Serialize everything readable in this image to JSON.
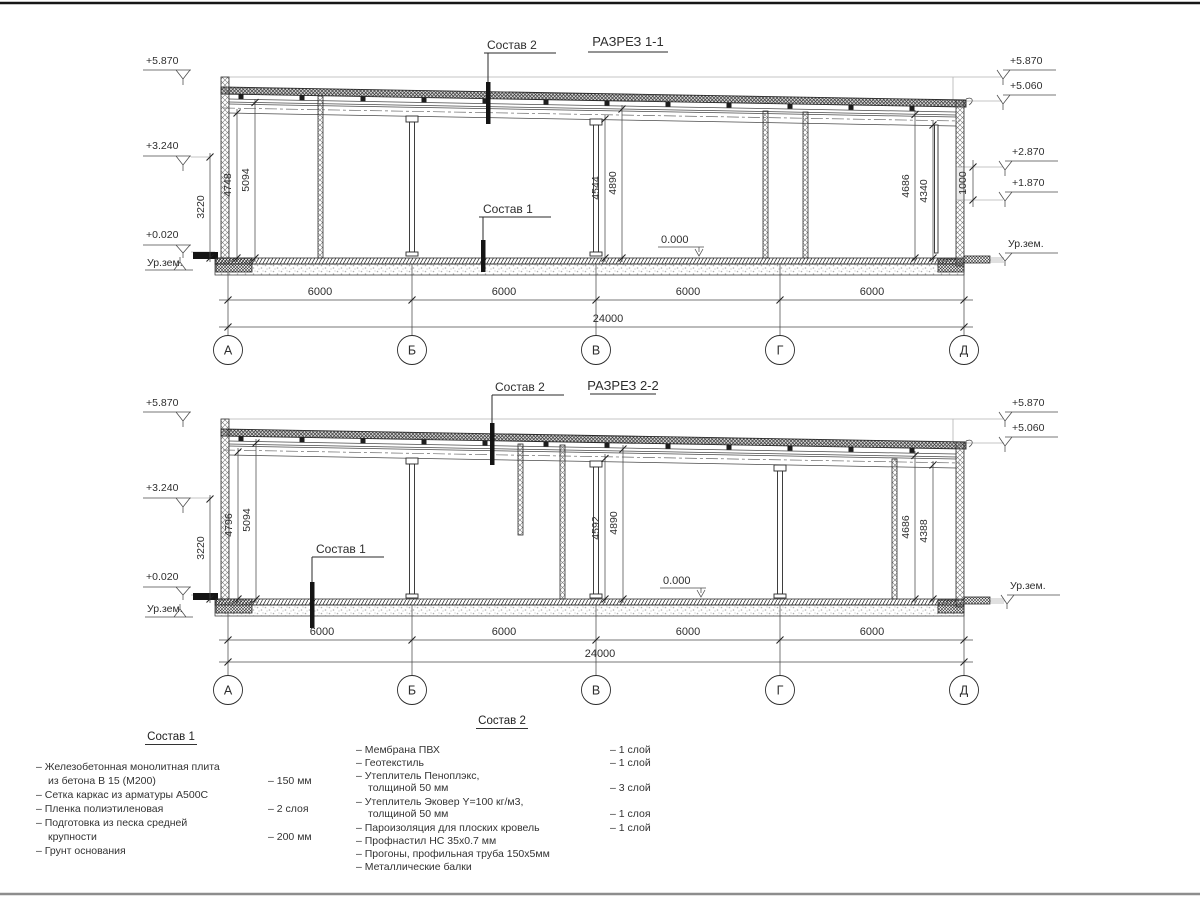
{
  "colors": {
    "line": "#2a2a2a",
    "gray": "#b3b3b3",
    "background": "#ffffff"
  },
  "s1": {
    "title": "РАЗРЕЗ 1-1",
    "sostav2": "Состав 2",
    "sostav1": "Состав 1",
    "zero": "0.000",
    "el_l1": "+5.870",
    "el_l2": "+3.240",
    "el_l3": "+0.020",
    "el_lg": "Ур.зем.",
    "el_r1": "+5.870",
    "el_r2": "+5.060",
    "el_r3": "+2.870",
    "el_r4": "+1.870",
    "el_rg": "Ур.зем.",
    "vd1": "3220",
    "vd2": "4748",
    "vd3": "5094",
    "vd4": "4544",
    "vd5": "4890",
    "vd6": "4686",
    "vd7": "4340",
    "vd8": "1000",
    "hd1": "6000",
    "hd2": "6000",
    "hd3": "6000",
    "hd4": "6000",
    "total": "24000",
    "ax1": "А",
    "ax2": "Б",
    "ax3": "В",
    "ax4": "Г",
    "ax5": "Д"
  },
  "s2": {
    "title": "РАЗРЕЗ 2-2",
    "sostav2": "Состав 2",
    "sostav1": "Состав 1",
    "zero": "0.000",
    "el_l1": "+5.870",
    "el_l2": "+3.240",
    "el_l3": "+0.020",
    "el_lg": "Ур.зем.",
    "el_r1": "+5.870",
    "el_r2": "+5.060",
    "el_rg": "Ур.зем.",
    "vd1": "3220",
    "vd2": "4796",
    "vd3": "5094",
    "vd4": "4592",
    "vd5": "4890",
    "vd6": "4686",
    "vd7": "4388",
    "hd1": "6000",
    "hd2": "6000",
    "hd3": "6000",
    "hd4": "6000",
    "total": "24000",
    "ax1": "А",
    "ax2": "Б",
    "ax3": "В",
    "ax4": "Г",
    "ax5": "Д"
  },
  "c1": {
    "title": "Состав 1",
    "rows": [
      {
        "t": "– Железобетонная  монолитная плита",
        "q": ""
      },
      {
        "t": "из бетона В 15 (М200)",
        "q": "– 150 мм"
      },
      {
        "t": "– Сетка каркас из арматуры А500С",
        "q": ""
      },
      {
        "t": "– Пленка полиэтиленовая",
        "q": "– 2 слоя"
      },
      {
        "t": "– Подготовка из песка средней",
        "q": ""
      },
      {
        "t": "крупности",
        "q": "– 200 мм"
      },
      {
        "t": "– Грунт основания",
        "q": ""
      }
    ]
  },
  "c2": {
    "title": "Состав 2",
    "rows": [
      {
        "t": "– Мембрана ПВХ",
        "q": "– 1 слой"
      },
      {
        "t": "– Геотекстиль",
        "q": "– 1 слой"
      },
      {
        "t": "– Утеплитель Пеноплэкс,",
        "q": ""
      },
      {
        "t": "толщиной 50 мм",
        "q": "– 3 слой"
      },
      {
        "t": "– Утеплитель Эковер Y=100 кг/м3,",
        "q": ""
      },
      {
        "t": "толщиной 50 мм",
        "q": "– 1 слоя"
      },
      {
        "t": "– Пароизоляция для плоских кровель",
        "q": "– 1 слой"
      },
      {
        "t": "– Профнастил НС 35х0.7 мм",
        "q": ""
      },
      {
        "t": "– Прогоны, профильная труба 150х5мм",
        "q": ""
      },
      {
        "t": "– Металлические балки",
        "q": ""
      }
    ]
  }
}
